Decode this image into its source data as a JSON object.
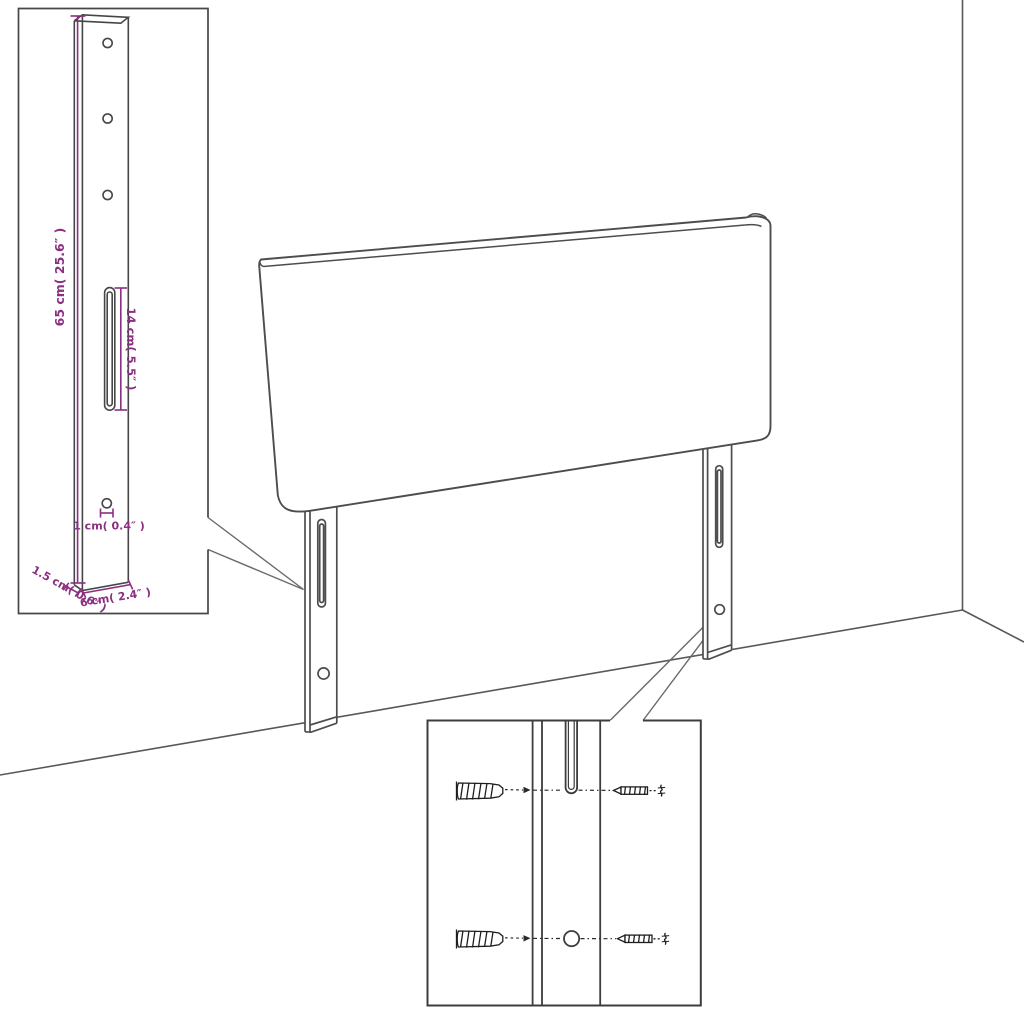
{
  "title": "Headboard mounting dimensions diagram",
  "colors": {
    "background": "#ffffff",
    "outline": "#4d4d4d",
    "hardware": "#1e1e1e",
    "dimension_accent": "#8b2f80"
  },
  "diagram": {
    "bracket_inset": {
      "labels": {
        "height": "65 cm( 25.6″ )",
        "slot_length": "14 cm( 5.5″ )",
        "hole_diameter": "1 cm( 0.4″ )",
        "thickness": "1.5 cm( 0.6″ )",
        "width": "6 cm( 2.4″ )"
      }
    }
  }
}
